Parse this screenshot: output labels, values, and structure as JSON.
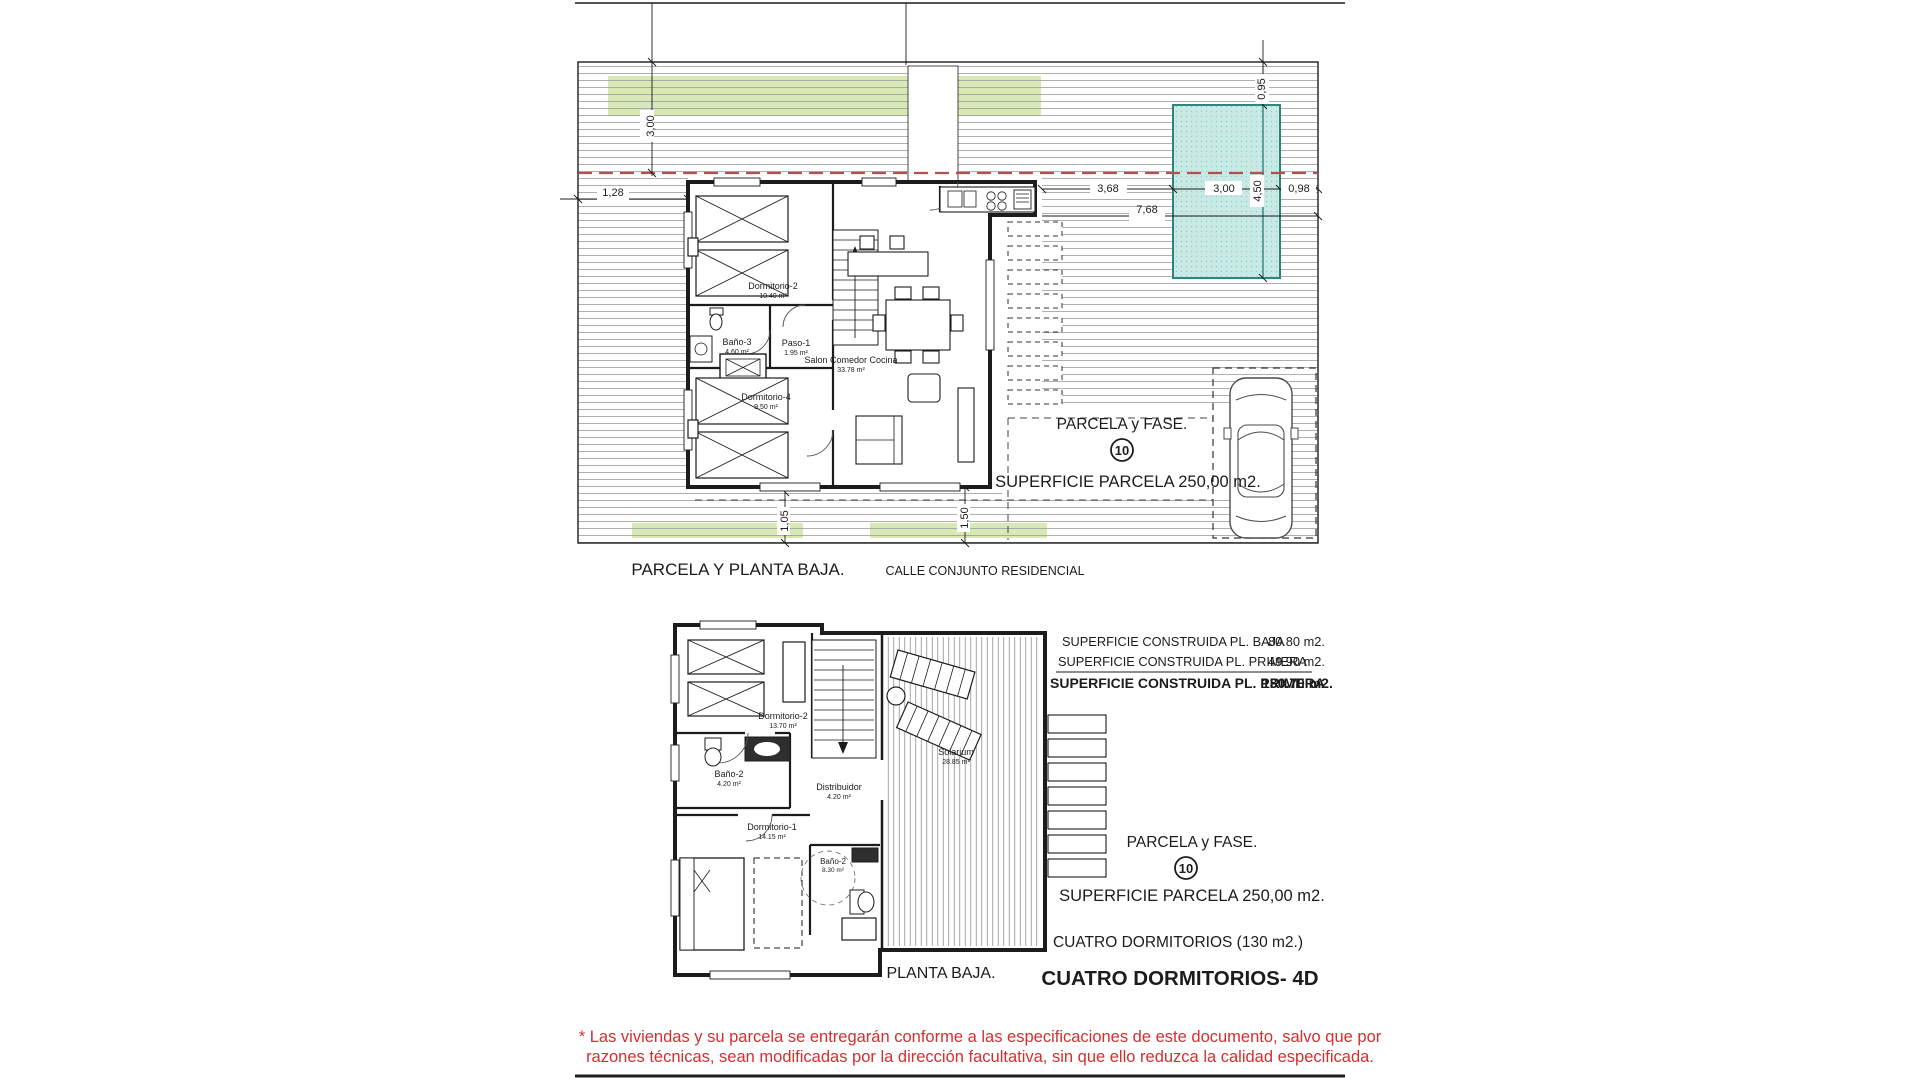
{
  "document": {
    "kind": "architectural floor plan sheet"
  },
  "colors": {
    "line": "#1c1c1c",
    "hatch": "#9b9b9b",
    "green_strip": "#d9e9b5",
    "pool_fill": "#c8e9e4",
    "pool_border": "#2e837d",
    "red_dash": "#b05050",
    "red_text": "#d32f2f"
  },
  "top_plan": {
    "caption": "PARCELA Y PLANTA BAJA.",
    "street_label": "CALLE CONJUNTO RESIDENCIAL",
    "parcel_label": "PARCELA y FASE.",
    "parcel_number": "10",
    "parcel_area_label": "SUPERFICIE PARCELA 250,00 m2.",
    "rooms": {
      "dormitorio2": {
        "name": "Dormitorio-2",
        "area": "10.40 m²"
      },
      "bano3": {
        "name": "Baño-3",
        "area": "4.60 m²"
      },
      "paso1": {
        "name": "Paso-1",
        "area": "1.95 m²"
      },
      "dormitorio4": {
        "name": "Dormitorio-4",
        "area": "9.50 m²"
      },
      "salon": {
        "name": "Salon Comedor Cocina",
        "area": "33.78 m²"
      }
    },
    "dimensions": {
      "v300": "3,00",
      "h128": "1,28",
      "v095": "0,95",
      "h368": "3,68",
      "h300": "3,00",
      "v450": "4,50",
      "h098": "0,98",
      "h768": "7,68",
      "v105": "1,05",
      "v150": "1,50"
    }
  },
  "bottom_plan": {
    "caption": "PLANTA BAJA.",
    "built_areas": [
      {
        "label": "SUPERFICIE CONSTRUIDA PL. BAJA",
        "value": "80.80 m2."
      },
      {
        "label": "SUPERFICIE CONSTRUIDA PL. PRIMERA",
        "value": "49.90 m2."
      },
      {
        "label": "SUPERFICIE CONSTRUIDA PL. PRIMERA",
        "value": "130.70  m2."
      }
    ],
    "parcel_label": "PARCELA y FASE.",
    "parcel_number": "10",
    "parcel_area_label": "SUPERFICIE PARCELA 250,00 m2.",
    "bedrooms_note": "CUATRO DORMITORIOS (130 m2.)",
    "plan_title": "CUATRO DORMITORIOS- 4D",
    "rooms": {
      "dormitorio2": {
        "name": "Dormitorio-2",
        "area": "13.70 m²"
      },
      "bano2": {
        "name": "Baño-2",
        "area": "4.20 m²"
      },
      "distribuidor": {
        "name": "Distribuidor",
        "area": "4.20 m²"
      },
      "dormitorio1": {
        "name": "Dormitorio-1",
        "area": "14.15 m²"
      },
      "bano2b": {
        "name": "Baño-2",
        "area": "8.30 m²"
      },
      "solarium": {
        "name": "Solarium",
        "area": "28.85 m²"
      }
    }
  },
  "disclaimer": {
    "line1": "* Las viviendas y su parcela se entregarán conforme a las especificaciones de este documento, salvo que por",
    "line2": "razones técnicas, sean modificadas por la dirección facultativa, sin que ello reduzca la calidad especificada."
  }
}
